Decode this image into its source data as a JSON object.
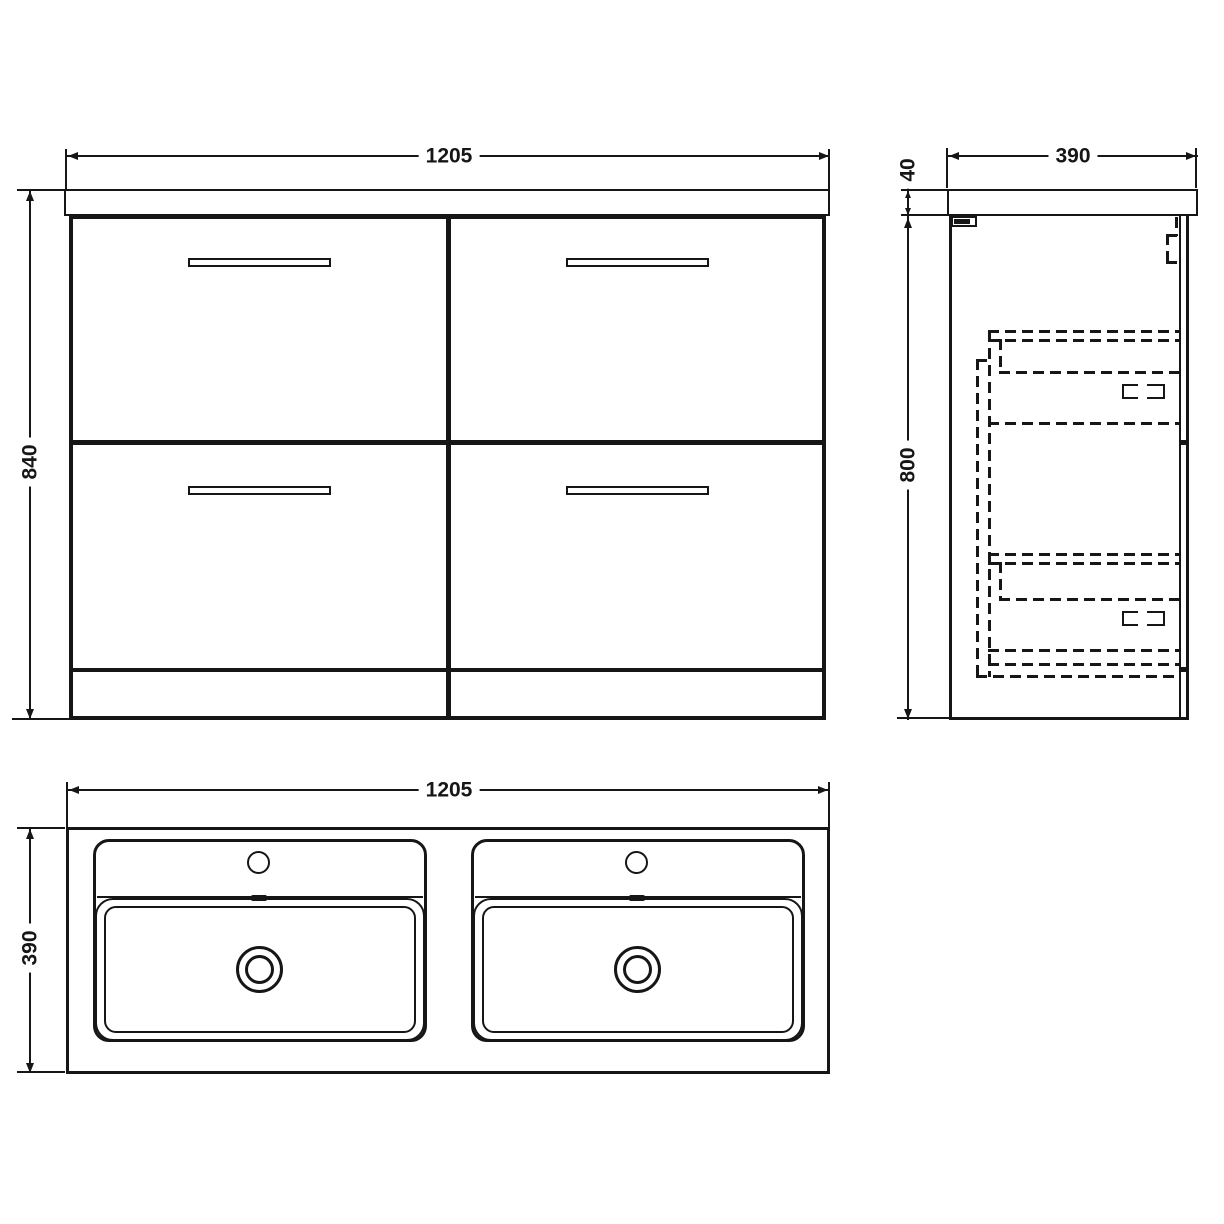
{
  "drawing": {
    "title": "vanity-unit-technical-drawing",
    "colors": {
      "line": "#161616",
      "background": "#ffffff"
    },
    "front_view": {
      "width_mm": "1205",
      "height_mm": "840"
    },
    "side_view": {
      "depth_mm": "390",
      "countertop_thickness_mm": "40",
      "cabinet_height_mm": "800"
    },
    "plan_view": {
      "width_mm": "1205",
      "depth_mm": "390"
    }
  }
}
